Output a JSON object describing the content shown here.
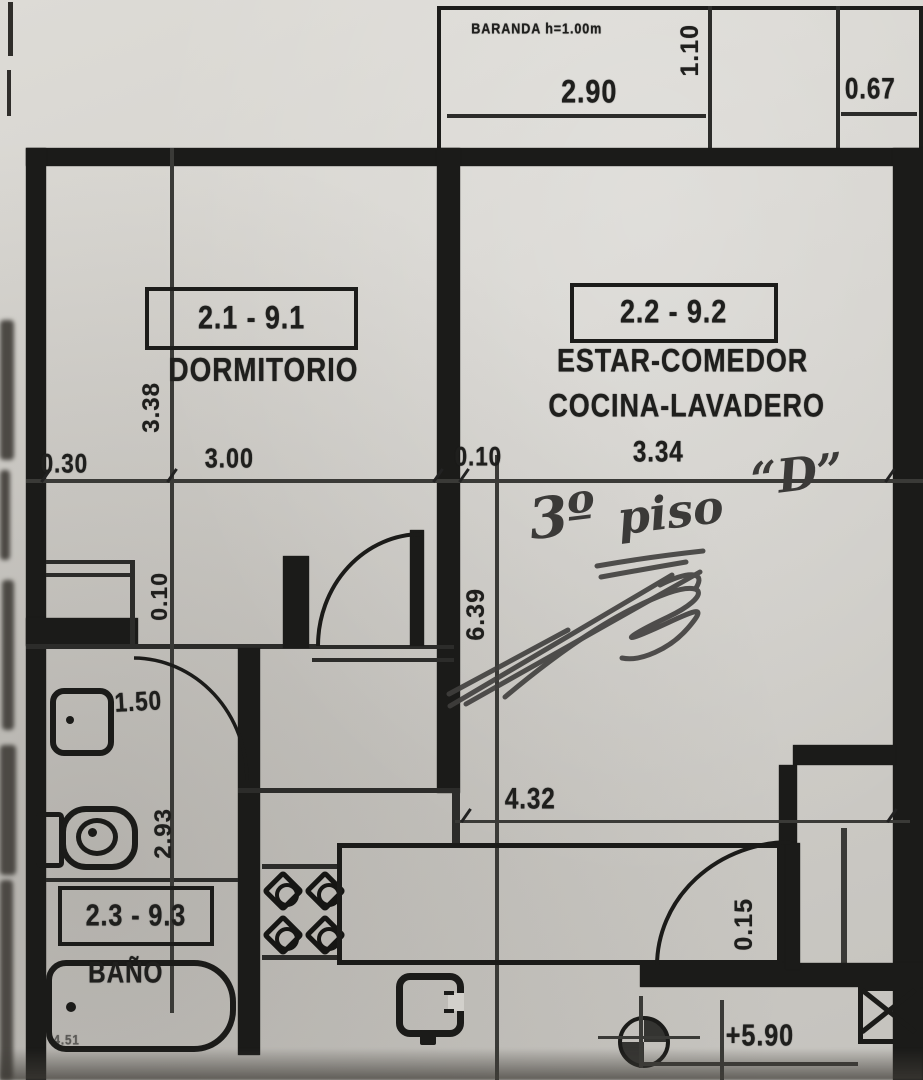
{
  "balcony": {
    "note": "BARANDA h=1.00m",
    "width_dim": "2.90",
    "depth_dim": "1.10",
    "side_dim": "0.67"
  },
  "rooms": {
    "dormitorio": {
      "code": "2.1 - 9.1",
      "label": "DORMITORIO"
    },
    "estar": {
      "code": "2.2 - 9.2",
      "label_line1": "ESTAR-COMEDOR",
      "label_line2": "COCINA-LAVADERO"
    },
    "bano": {
      "code": "2.3 - 9.3",
      "label": "BAÑO",
      "footnote": "4.51"
    }
  },
  "dims": {
    "left_offset": "0.30",
    "dorm_width": "3.00",
    "wall_gap": "0.10",
    "estar_width": "3.34",
    "dorm_height": "3.38",
    "inner_gap": "0.10",
    "estar_depth": "6.39",
    "bath_pass": "1.50",
    "kitchen_width": "4.32",
    "bath_depth": "2.93",
    "entry_wall": "0.15",
    "level_mark": "+5.90"
  },
  "handwriting": {
    "part1": "3º",
    "part2": "piso",
    "part3": "“D”"
  }
}
